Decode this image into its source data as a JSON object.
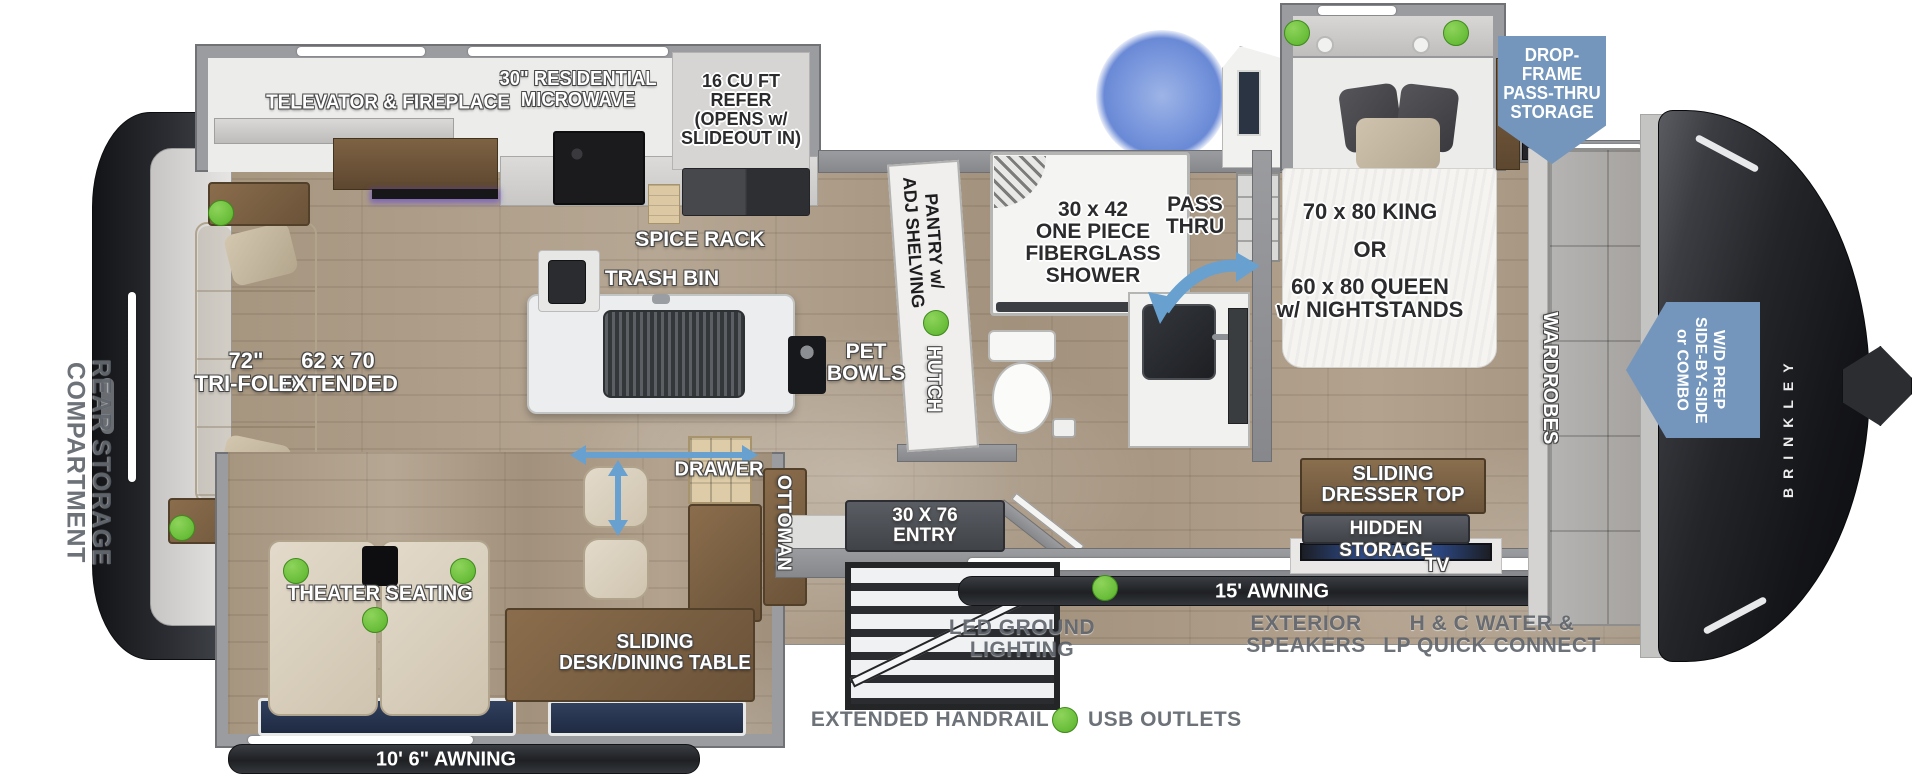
{
  "fp": {
    "exterior": {
      "rear_storage": "REAR STORAGE COMPARTMENT",
      "brand": "BRINKLEY",
      "awning_rear": "10' 6\" AWNING",
      "awning_front": "15' AWNING",
      "led_ground": "LED GROUND\nLIGHTING",
      "speakers": "EXTERIOR\nSPEAKERS",
      "hc_water": "H & C WATER &\nLP QUICK CONNECT",
      "handrail": "EXTENDED HANDRAIL",
      "usb_outlets": "USB OUTLETS",
      "entry": "30 X 76\nENTRY"
    },
    "callouts": {
      "drop_frame": "DROP-FRAME\nPASS-THRU\nSTORAGE",
      "wd_prep": "W/D PREP\nSIDE-BY-SIDE\nor COMBO"
    },
    "living": {
      "televator": "TELEVATOR & FIREPLACE",
      "microwave": "30\" RESIDENTIAL\nMICROWAVE",
      "refer": "16 CU FT\nREFER\n(OPENS w/\nSLIDEOUT IN)",
      "spice_rack": "SPICE RACK",
      "trash_bin": "TRASH BIN",
      "pet_bowls": "PET\nBOWLS",
      "tri_fold": "72\"\nTRI-FOLD",
      "extended": "62 x 70\nEXTENDED",
      "theater": "THEATER SEATING",
      "drawer": "DRAWER",
      "ottoman": "OTTOMAN",
      "desk": "SLIDING\nDESK/DINING TABLE"
    },
    "bath": {
      "pantry": "PANTRY w/\nADJ SHELVING",
      "hutch": "HUTCH",
      "shower": "30 x 42\nONE PIECE\nFIBERGLASS\nSHOWER",
      "pass_thru": "PASS\nTHRU"
    },
    "bedroom": {
      "king": "70 x 80 KING",
      "or": "OR",
      "queen": "60 x 80 QUEEN\nw/ NIGHTSTANDS",
      "wardrobes": "WARDROBES",
      "dresser": "SLIDING\nDRESSER TOP",
      "hidden": "HIDDEN STORAGE",
      "tv": "TV"
    },
    "colors": {
      "usb_green": "#6cbf3f",
      "callout_blue": "#7496bd",
      "arrow_blue": "#68a0cf"
    }
  }
}
